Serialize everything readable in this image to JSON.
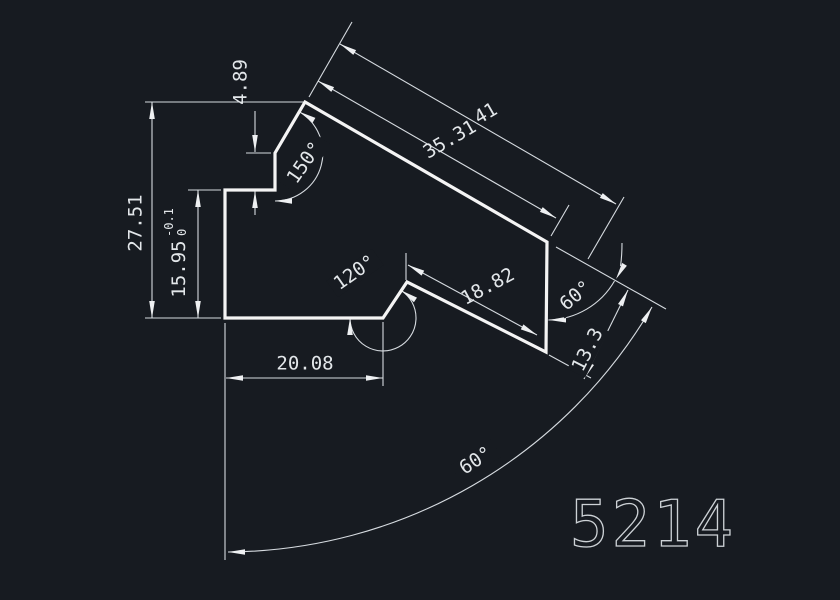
{
  "drawing": {
    "part_number": "5214",
    "colors": {
      "background": "#171b21",
      "part_line": "#f4f4f4",
      "dimension_line": "#d6dbe0",
      "text": "#e3e7ea"
    },
    "dims": {
      "total_height": "27.51",
      "left_height": "15.95",
      "left_height_tol_top": "-0.1",
      "left_height_tol_bottom": "0",
      "step_height": "4.89",
      "bottom_width": "20.08",
      "top_edge_full": "41",
      "top_edge": "35.31",
      "lower_edge": "18.82",
      "right_edge": "13.3",
      "angle_peak": "150°",
      "angle_notch": "120°",
      "angle_bend": "60°",
      "angle_base": "60°"
    }
  }
}
